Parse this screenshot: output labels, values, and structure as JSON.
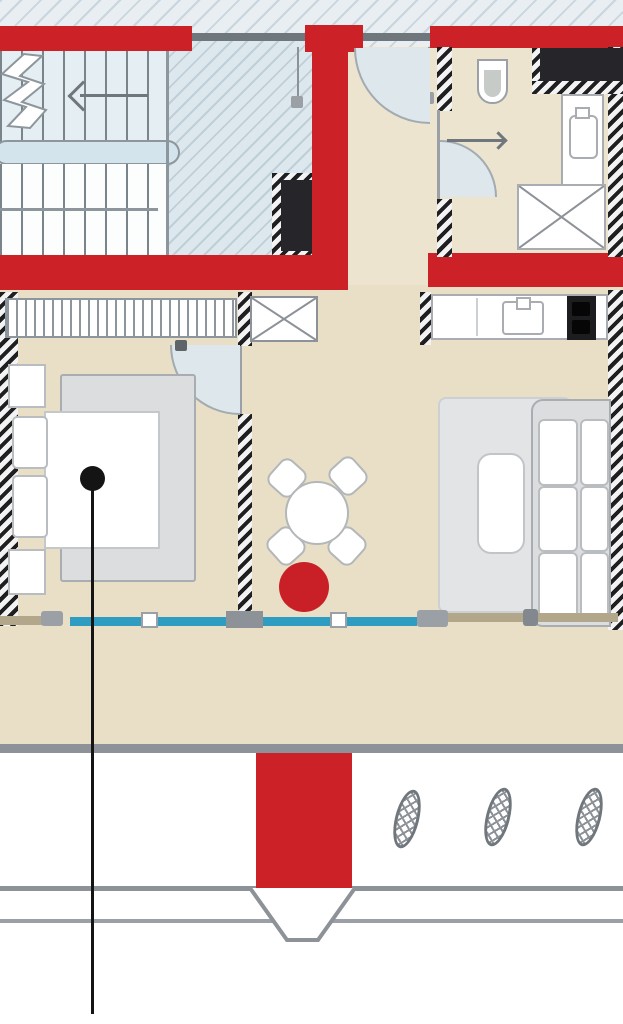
{
  "image": {
    "type": "architectural-floor-plan",
    "width": 623,
    "height": 1024
  },
  "colors": {
    "wall-red": "#cb2127",
    "floor-beige": "#e8dfc6",
    "floor-light": "#ece4cf",
    "ext-bg": "#e9eef2",
    "ext-line": "#c9d6dd",
    "well-bg": "#dde8ee",
    "well-line": "#bfcfd8",
    "stair-upper": "#e4eef3",
    "stair-lower": "#fcfdfd",
    "tread": "#79848b",
    "landing": "#d3e4ec",
    "line-gray": "#8d9298",
    "line-dark": "#70777c",
    "edge-gray": "#8d969c",
    "wall-dark": "#1f1f22",
    "wall-light": "#f3f3f3",
    "fixture-dark": "#26262a",
    "swing-fill": "#dee7eb",
    "swing-edge": "#a2abb1",
    "furn-gray": "#dbdddf",
    "furn-border": "#a9adb1",
    "white": "#ffffff",
    "white-border": "#b9bdc0",
    "rug": "#e3e4e5",
    "rug-border": "#cdd0d2",
    "window-blue": "#2f9cc1",
    "parapet-tan": "#b2a78a",
    "knob": "#9aa0a5",
    "marker-red": "#c92027",
    "ink": "#141414"
  },
  "plan": {
    "areas": [
      "stairwell",
      "entry-hall",
      "bathroom",
      "bedroom",
      "dining-area",
      "kitchen",
      "living-room",
      "balcony",
      "ground-exterior"
    ],
    "fixtures": [
      "staircase-two-flights",
      "stair-direction-arrow",
      "stair-break-line",
      "entry-door-swing",
      "bathroom-door-swing",
      "bedroom-door-swing",
      "toilet",
      "washbasin",
      "shower-tray",
      "duct-shaft-dark",
      "duct-cross-box",
      "wardrobe",
      "double-bed",
      "nightstands",
      "round-dining-table",
      "dining-chairs",
      "red-marker-circle",
      "kitchen-counter",
      "kitchen-sink",
      "cooktop",
      "rug",
      "coffee-table",
      "sofa",
      "balcony-glazing",
      "balcony-parapet",
      "entrance-pier",
      "shrub-symbols",
      "annotation-leader"
    ],
    "counts": {
      "dining_chairs": 4,
      "sofa_cushion_rows": 3,
      "shrub_symbols": 3,
      "window_glass_segments": 4
    }
  }
}
